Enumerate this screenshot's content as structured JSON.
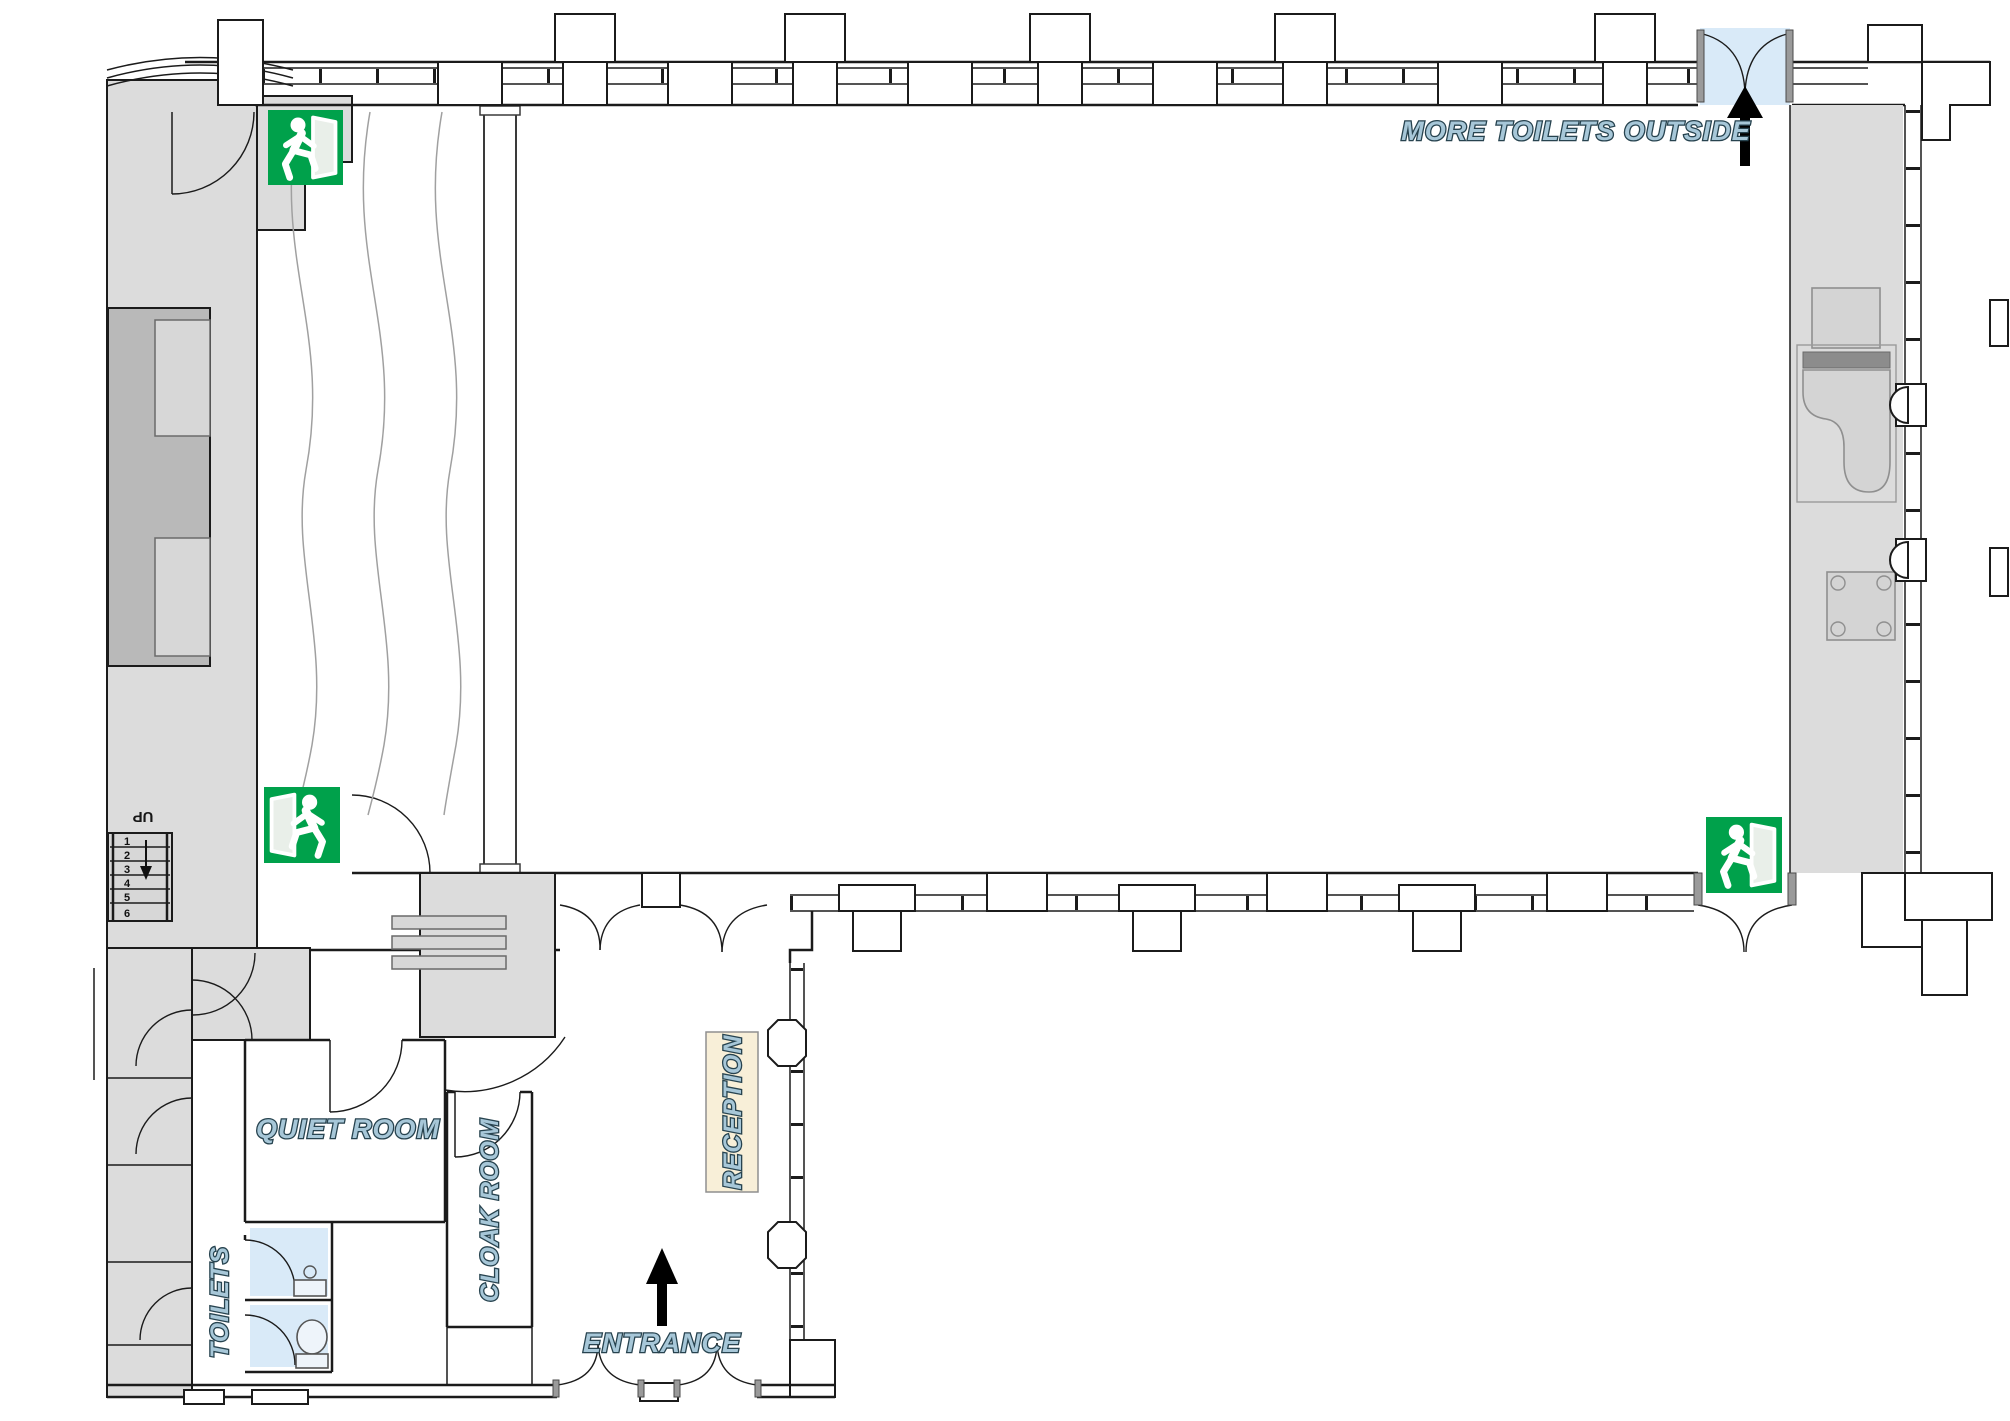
{
  "labels": {
    "more_toilets_outside": "MORE TOILETS OUTSIDE",
    "quiet_room": "QUIET ROOM",
    "cloak_room": "CLOAK ROOM",
    "toilets": "TOILETS",
    "reception": "RECEPTION",
    "entrance": "ENTRANCE",
    "stairs_up": "UP"
  },
  "stairs": {
    "steps": [
      "1",
      "2",
      "3",
      "4",
      "5",
      "6"
    ]
  },
  "icons": {
    "exit_sign": "emergency-exit-running-man-icon",
    "entrance_arrow": "up-arrow-icon",
    "outside_arrow": "up-arrow-icon",
    "stairs_direction_arrow": "down-arrow-icon",
    "door_swing": "quarter-arc-door-swing"
  },
  "colors": {
    "exit_sign_green": "#00a14b",
    "exterior_door_blue": "#d9eaf8",
    "toilet_floor_blue": "#d9eaf8",
    "label_text_fill": "#a7c7d8",
    "label_text_outline": "#27434f",
    "reception_cream": "#f8efd8",
    "wall_line": "#1b1b1b",
    "floor_gray_light": "#dcdcdc",
    "floor_gray_dark": "#b9b9b9"
  }
}
